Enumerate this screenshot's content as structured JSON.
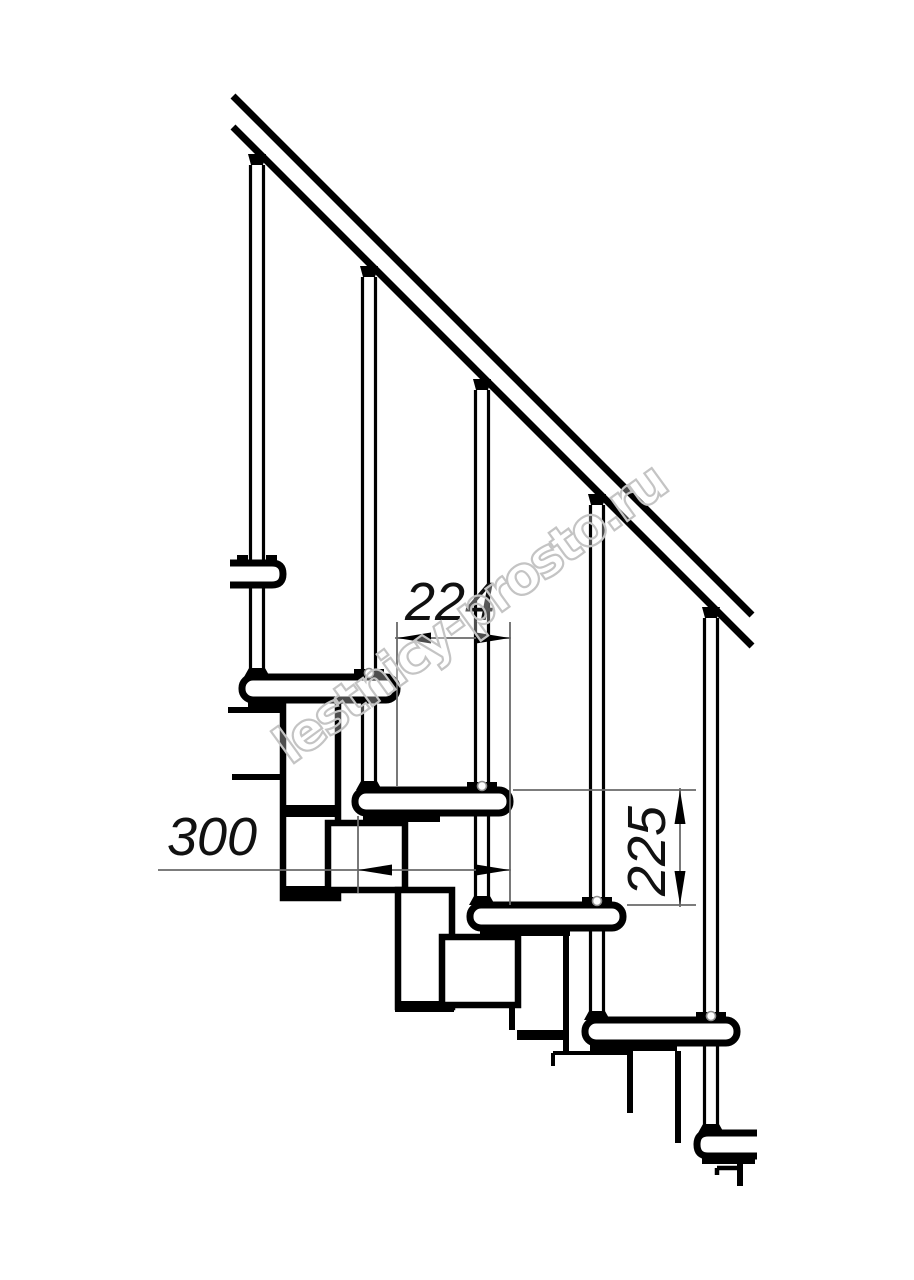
{
  "drawing": {
    "type": "staircase-side-view-technical-drawing",
    "watermark": {
      "text": "lestnicy-prosto.ru",
      "color": "#c4c4c4"
    },
    "dimensions": {
      "run": {
        "value": "224",
        "orientation": "horizontal",
        "meaning": "step run between tread noses"
      },
      "tread_depth": {
        "value": "300",
        "orientation": "horizontal",
        "meaning": "tread depth"
      },
      "rise": {
        "value": "225",
        "orientation": "vertical",
        "meaning": "step rise between treads"
      }
    },
    "structure": {
      "balusters_visible": 5,
      "treads_full_visible": 4,
      "treads_partial_visible": 2,
      "handrail_lines": 2
    },
    "colors": {
      "line": "#000000",
      "dimension_line": "#6a6a6a",
      "arrow": "#000000",
      "detail_circle": "#8f8f8f",
      "background": "#ffffff"
    }
  }
}
